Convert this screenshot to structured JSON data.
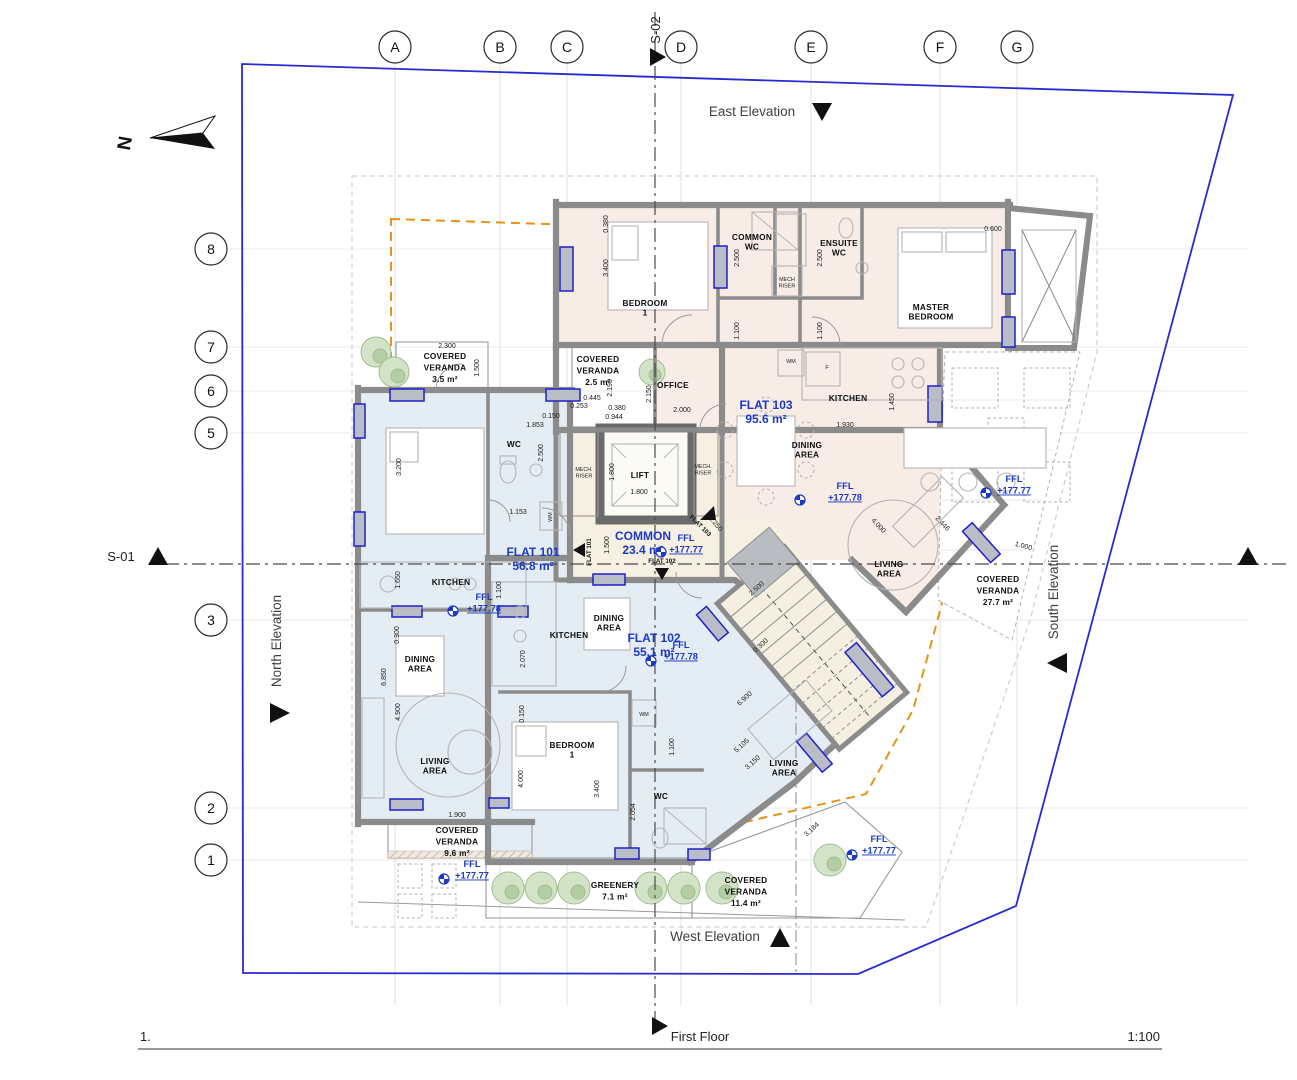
{
  "colors": {
    "accent": "#1d39c4",
    "boundary": "#2a2ad0",
    "orange": "#e8921a",
    "wall": "#8b8b8b",
    "flat_pink": "#f8ece6",
    "flat_blue": "#e4edf3",
    "common_cream": "#f5f0e2",
    "greenery": "#d2e3c8"
  },
  "title_block": {
    "drawing_number": "1.",
    "drawing_title": "First Floor",
    "drawing_scale": "1:100"
  },
  "north_label": "N",
  "sections": {
    "s01": "S-01",
    "s02": "S-02"
  },
  "elevations": {
    "east": "East Elevation",
    "west": "West Elevation",
    "north": "North Elevation",
    "south": "South Elevation"
  },
  "grid": {
    "cols": [
      {
        "label": "A",
        "x": 395
      },
      {
        "label": "B",
        "x": 500
      },
      {
        "label": "C",
        "x": 567
      },
      {
        "label": "D",
        "x": 681
      },
      {
        "label": "E",
        "x": 811
      },
      {
        "label": "F",
        "x": 940
      },
      {
        "label": "G",
        "x": 1017
      }
    ],
    "rows": [
      {
        "label": "8",
        "y": 249
      },
      {
        "label": "7",
        "y": 347
      },
      {
        "label": "6",
        "y": 391
      },
      {
        "label": "5",
        "y": 433
      },
      {
        "label": "3",
        "y": 620
      },
      {
        "label": "2",
        "y": 808
      },
      {
        "label": "1",
        "y": 860
      }
    ]
  },
  "text_layers": [
    {
      "cls": "flat",
      "name": "flat-label",
      "lh": 14,
      "items": [
        {
          "lines": [
            "FLAT 101",
            "56.8 m²"
          ],
          "x": 533,
          "y": 556
        },
        {
          "lines": [
            "FLAT 102",
            "55.1 m²"
          ],
          "x": 654,
          "y": 642
        },
        {
          "lines": [
            "FLAT 103",
            "95.6 m²"
          ],
          "x": 766,
          "y": 409
        },
        {
          "lines": [
            "COMMON",
            "23.4 m²"
          ],
          "x": 643,
          "y": 540
        }
      ]
    },
    {
      "cls": "room",
      "name": "room-label",
      "lh": 9.5,
      "items": [
        {
          "lines": [
            "BEDROOM",
            "1"
          ],
          "x": 645,
          "y": 306
        },
        {
          "lines": [
            "COMMON",
            "WC"
          ],
          "x": 752,
          "y": 240
        },
        {
          "lines": [
            "ENSUITE",
            "WC"
          ],
          "x": 839,
          "y": 246
        },
        {
          "lines": [
            "MASTER",
            "BEDROOM"
          ],
          "x": 931,
          "y": 310
        },
        {
          "lines": [
            "OFFICE"
          ],
          "x": 673,
          "y": 388
        },
        {
          "lines": [
            "KITCHEN"
          ],
          "x": 848,
          "y": 401
        },
        {
          "lines": [
            "DINING",
            "AREA"
          ],
          "x": 807,
          "y": 448
        },
        {
          "lines": [
            "LIVING",
            "AREA"
          ],
          "x": 889,
          "y": 567
        },
        {
          "lines": [
            "LIFT"
          ],
          "x": 640,
          "y": 478
        },
        {
          "lines": [
            "WC"
          ],
          "x": 514,
          "y": 447
        },
        {
          "lines": [
            "KITCHEN"
          ],
          "x": 451,
          "y": 585
        },
        {
          "lines": [
            "DINING",
            "AREA"
          ],
          "x": 420,
          "y": 662
        },
        {
          "lines": [
            "LIVING",
            "AREA"
          ],
          "x": 435,
          "y": 764
        },
        {
          "lines": [
            "KITCHEN"
          ],
          "x": 569,
          "y": 638
        },
        {
          "lines": [
            "DINING",
            "AREA"
          ],
          "x": 609,
          "y": 621
        },
        {
          "lines": [
            "BEDROOM",
            "1"
          ],
          "x": 572,
          "y": 748
        },
        {
          "lines": [
            "WC"
          ],
          "x": 661,
          "y": 799
        },
        {
          "lines": [
            "LIVING",
            "AREA"
          ],
          "x": 784,
          "y": 766
        }
      ]
    },
    {
      "cls": "room",
      "name": "veranda-label",
      "lh": 11.5,
      "items": [
        {
          "lines": [
            "COVERED",
            "VERANDA",
            "3.5 m²"
          ],
          "x": 445,
          "y": 359
        },
        {
          "lines": [
            "COVERED",
            "VERANDA",
            "2.5 m²"
          ],
          "x": 598,
          "y": 362
        },
        {
          "lines": [
            "COVERED",
            "VERANDA",
            "27.7 m²"
          ],
          "x": 998,
          "y": 582
        },
        {
          "lines": [
            "COVERED",
            "VERANDA",
            "9.6 m²"
          ],
          "x": 457,
          "y": 833
        },
        {
          "lines": [
            "COVERED",
            "VERANDA",
            "11.4 m²"
          ],
          "x": 746,
          "y": 883
        },
        {
          "lines": [
            "GREENERY",
            "7.1 m²"
          ],
          "x": 615,
          "y": 888
        }
      ]
    },
    {
      "cls": "tiny",
      "name": "tiny-label",
      "lh": 6.5,
      "items": [
        {
          "lines": [
            "MECH.",
            "RISER"
          ],
          "x": 584,
          "y": 471
        },
        {
          "lines": [
            "MECH.",
            "RISER"
          ],
          "x": 703,
          "y": 468
        },
        {
          "lines": [
            "MECH",
            "RISER"
          ],
          "x": 787,
          "y": 281
        },
        {
          "lines": [
            "WM"
          ],
          "x": 791,
          "y": 363
        },
        {
          "lines": [
            "WM"
          ],
          "x": 552,
          "y": 517,
          "r": -90
        },
        {
          "lines": [
            "WM"
          ],
          "x": 644,
          "y": 716
        },
        {
          "lines": [
            "F"
          ],
          "x": 827,
          "y": 369
        }
      ]
    },
    {
      "cls": "tag",
      "name": "flat-tag",
      "lh": 7,
      "items": [
        {
          "lines": [
            "FLAT 101"
          ],
          "x": 591,
          "y": 552,
          "r": -90
        },
        {
          "lines": [
            "FLAT 102"
          ],
          "x": 662,
          "y": 563
        },
        {
          "lines": [
            "FLAT 103"
          ],
          "x": 699,
          "y": 527,
          "r": 45
        }
      ]
    },
    {
      "cls": "dim",
      "name": "dimension-label",
      "lh": 8,
      "items": [
        {
          "lines": [
            "0.380"
          ],
          "x": 608,
          "y": 224,
          "r": -90
        },
        {
          "lines": [
            "3.400"
          ],
          "x": 608,
          "y": 268,
          "r": -90
        },
        {
          "lines": [
            "2.500"
          ],
          "x": 739,
          "y": 258,
          "r": -90
        },
        {
          "lines": [
            "1.100"
          ],
          "x": 739,
          "y": 331,
          "r": -90
        },
        {
          "lines": [
            "2.500"
          ],
          "x": 822,
          "y": 258,
          "r": -90
        },
        {
          "lines": [
            "1.100"
          ],
          "x": 822,
          "y": 331,
          "r": -90
        },
        {
          "lines": [
            "0.600"
          ],
          "x": 993,
          "y": 231
        },
        {
          "lines": [
            "2.300"
          ],
          "x": 447,
          "y": 348
        },
        {
          "lines": [
            "1.500"
          ],
          "x": 479,
          "y": 368,
          "r": -90
        },
        {
          "lines": [
            "2.190"
          ],
          "x": 612,
          "y": 388,
          "r": -90
        },
        {
          "lines": [
            "2.150"
          ],
          "x": 651,
          "y": 394,
          "r": -90
        },
        {
          "lines": [
            "2.000"
          ],
          "x": 682,
          "y": 412
        },
        {
          "lines": [
            "0.445"
          ],
          "x": 592,
          "y": 400
        },
        {
          "lines": [
            "0.253"
          ],
          "x": 579,
          "y": 408
        },
        {
          "lines": [
            "0.380"
          ],
          "x": 617,
          "y": 410
        },
        {
          "lines": [
            "0.944"
          ],
          "x": 614,
          "y": 419
        },
        {
          "lines": [
            "0.150"
          ],
          "x": 551,
          "y": 418
        },
        {
          "lines": [
            "1.853"
          ],
          "x": 535,
          "y": 427
        },
        {
          "lines": [
            "2.500"
          ],
          "x": 543,
          "y": 453,
          "r": -90
        },
        {
          "lines": [
            "3.200"
          ],
          "x": 401,
          "y": 467,
          "r": -90
        },
        {
          "lines": [
            "1.800"
          ],
          "x": 614,
          "y": 472,
          "r": -90
        },
        {
          "lines": [
            "1.800"
          ],
          "x": 639,
          "y": 494
        },
        {
          "lines": [
            "1.500"
          ],
          "x": 609,
          "y": 545,
          "r": -90
        },
        {
          "lines": [
            "1.250"
          ],
          "x": 714,
          "y": 525,
          "r": 50
        },
        {
          "lines": [
            "1.153"
          ],
          "x": 518,
          "y": 514
        },
        {
          "lines": [
            "1.650"
          ],
          "x": 400,
          "y": 580,
          "r": -90
        },
        {
          "lines": [
            "1.100"
          ],
          "x": 501,
          "y": 590,
          "r": -90
        },
        {
          "lines": [
            "0.300"
          ],
          "x": 399,
          "y": 635,
          "r": -90
        },
        {
          "lines": [
            "6.850"
          ],
          "x": 386,
          "y": 677,
          "r": -90
        },
        {
          "lines": [
            "4.900"
          ],
          "x": 400,
          "y": 712,
          "r": -90
        },
        {
          "lines": [
            "2.070"
          ],
          "x": 525,
          "y": 659,
          "r": -90
        },
        {
          "lines": [
            "0.150"
          ],
          "x": 524,
          "y": 714,
          "r": -90
        },
        {
          "lines": [
            "4.000"
          ],
          "x": 523,
          "y": 779,
          "r": -90
        },
        {
          "lines": [
            "3.400"
          ],
          "x": 599,
          "y": 789,
          "r": -90
        },
        {
          "lines": [
            "2.054"
          ],
          "x": 635,
          "y": 812,
          "r": -90
        },
        {
          "lines": [
            "1.100"
          ],
          "x": 674,
          "y": 747,
          "r": -90
        },
        {
          "lines": [
            "1.900"
          ],
          "x": 457,
          "y": 817
        },
        {
          "lines": [
            "1.450"
          ],
          "x": 894,
          "y": 402,
          "r": -90
        },
        {
          "lines": [
            "1.930"
          ],
          "x": 845,
          "y": 427
        },
        {
          "lines": [
            "4.000"
          ],
          "x": 877,
          "y": 527,
          "r": 47
        },
        {
          "lines": [
            "2.446"
          ],
          "x": 941,
          "y": 525,
          "r": 47
        },
        {
          "lines": [
            "1.000"
          ],
          "x": 1023,
          "y": 548,
          "r": 15
        },
        {
          "lines": [
            "2.500"
          ],
          "x": 758,
          "y": 590,
          "r": -42
        },
        {
          "lines": [
            "0.300"
          ],
          "x": 762,
          "y": 647,
          "r": -42
        },
        {
          "lines": [
            "6.900"
          ],
          "x": 746,
          "y": 700,
          "r": -42
        },
        {
          "lines": [
            "5.105"
          ],
          "x": 743,
          "y": 747,
          "r": -42
        },
        {
          "lines": [
            "3.150"
          ],
          "x": 754,
          "y": 764,
          "r": -42
        },
        {
          "lines": [
            "3.184"
          ],
          "x": 813,
          "y": 831,
          "r": -42
        }
      ]
    }
  ],
  "ffl_markers": [
    {
      "label": "FFL",
      "value": "+177.78",
      "ix": 800,
      "iy": 500,
      "tx": 845,
      "ty": 489
    },
    {
      "label": "FFL",
      "value": "+177.77",
      "ix": 661,
      "iy": 552,
      "tx": 686,
      "ty": 541
    },
    {
      "label": "FFL",
      "value": "+177.77",
      "ix": 986,
      "iy": 493,
      "tx": 1014,
      "ty": 482
    },
    {
      "label": "FFL",
      "value": "+177.78",
      "ix": 453,
      "iy": 611,
      "tx": 484,
      "ty": 600
    },
    {
      "label": "FFL",
      "value": "+177.77",
      "ix": 444,
      "iy": 879,
      "tx": 472,
      "ty": 867
    },
    {
      "label": "FFL",
      "value": "+177.77",
      "ix": 852,
      "iy": 855,
      "tx": 879,
      "ty": 842
    },
    {
      "label": "FFL",
      "value": "+177.78",
      "ix": 651,
      "iy": 661,
      "tx": 681,
      "ty": 648
    }
  ]
}
